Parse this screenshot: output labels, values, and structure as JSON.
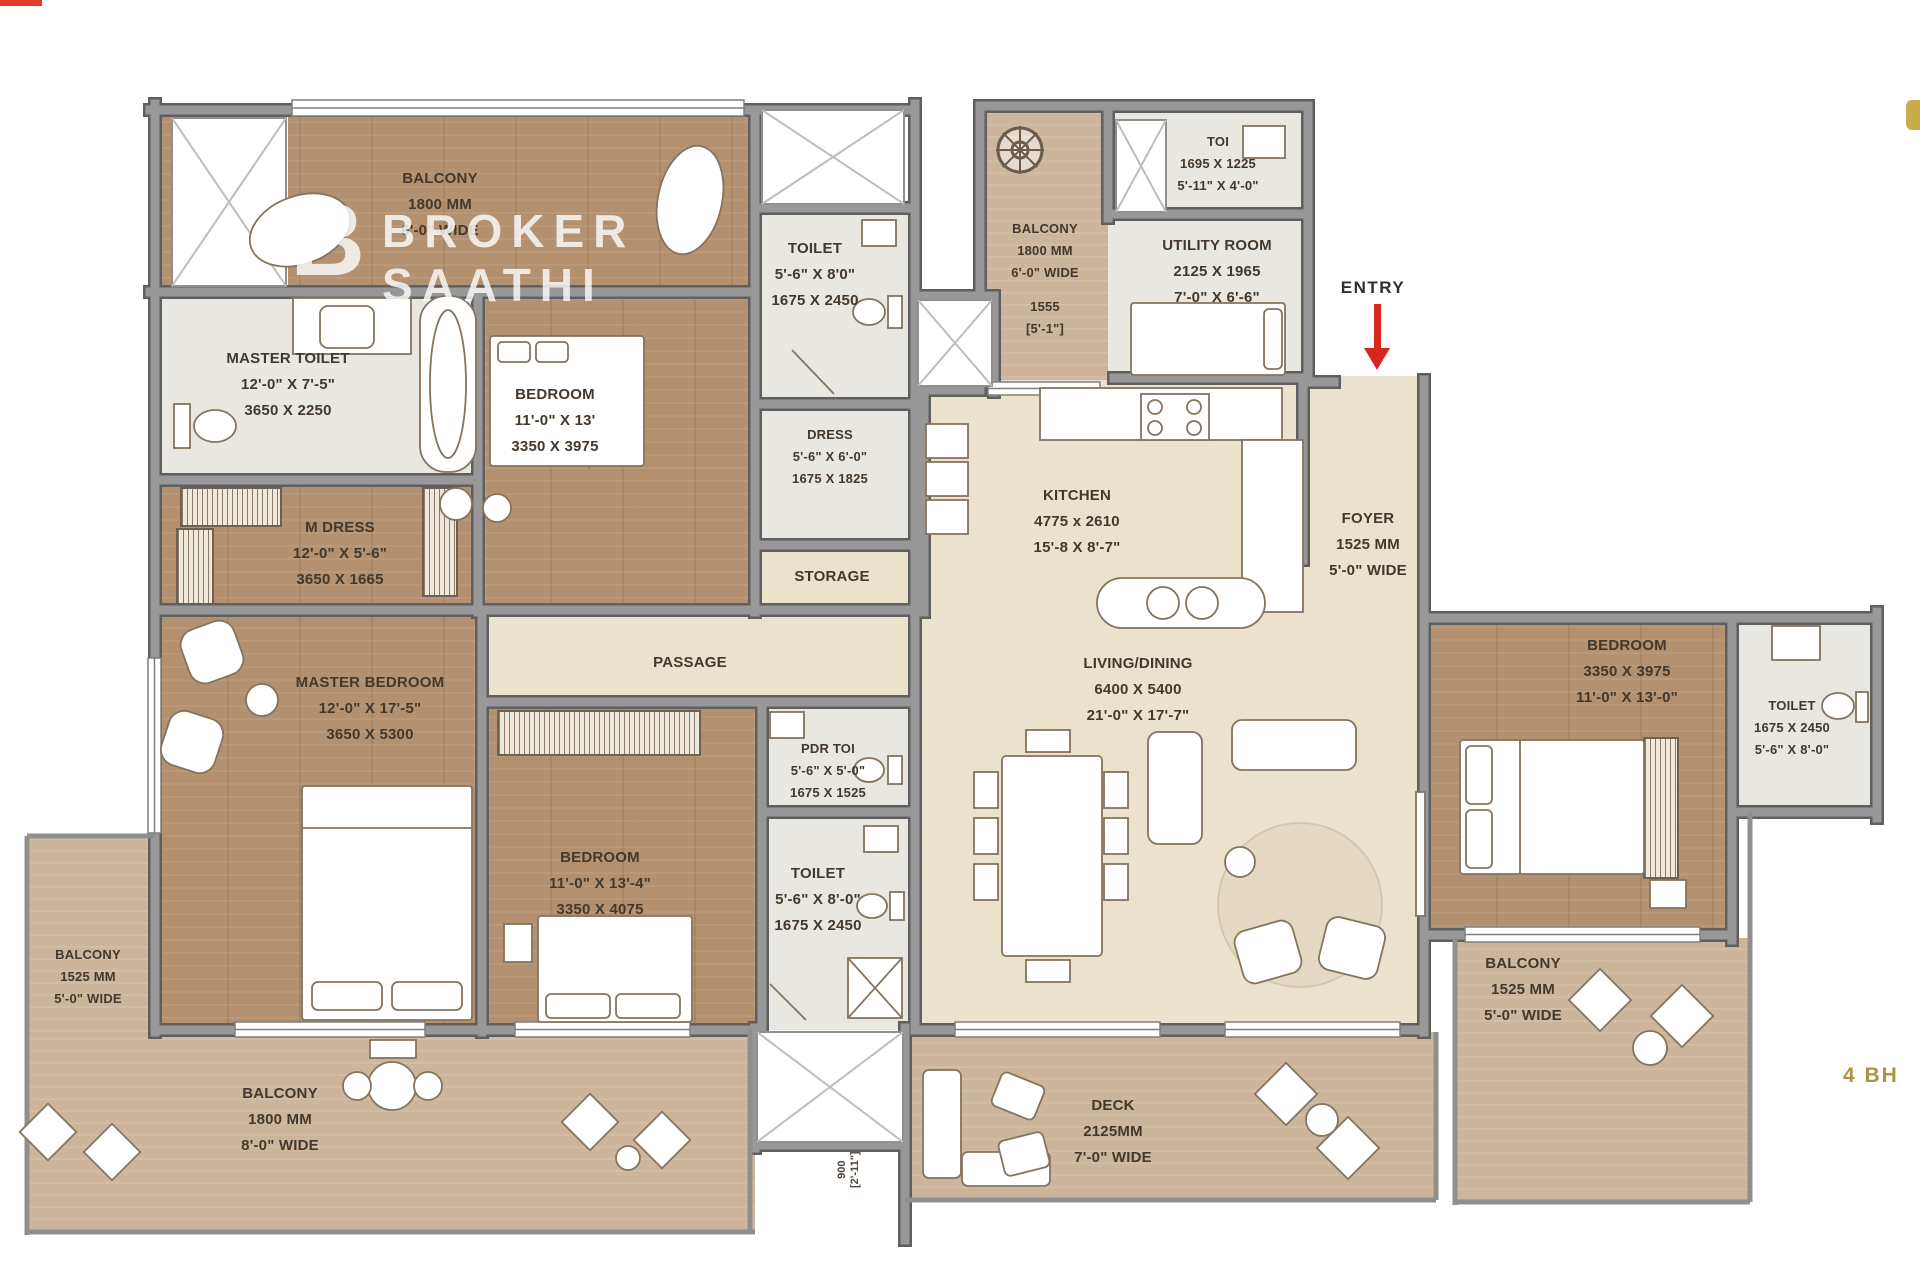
{
  "plan_type": "apartment-floor-plan",
  "watermark": {
    "logo": "B",
    "line1": "BROKER",
    "line2": "SAATHI"
  },
  "annotations": {
    "entry": "ENTRY",
    "bhk": "4 BH",
    "dim900_mm": "900",
    "dim900_ft": "[2'-11\"]"
  },
  "colors": {
    "wood_floor": "#b3906f",
    "balcony_floor": "#cdb59b",
    "living_floor": "#ebe2cd",
    "wall": "#949494",
    "entry_arrow": "#d8281e",
    "bhk_text": "#ab9440"
  },
  "rooms": {
    "balcony_tl": {
      "lines": [
        "BALCONY",
        "1800 MM",
        "6'-0\" WIDE"
      ]
    },
    "master_toilet": {
      "lines": [
        "MASTER TOILET",
        "12'-0\" X 7'-5\"",
        "3650 X 2250"
      ]
    },
    "bedroom_tl": {
      "lines": [
        "BEDROOM",
        "11'-0\" X 13'",
        "3350 X 3975"
      ]
    },
    "toilet_top": {
      "lines": [
        "TOILET",
        "5'-6\" X 8'0\"",
        "1675 X 2450"
      ]
    },
    "dress": {
      "lines": [
        "DRESS",
        "5'-6\" X 6'-0\"",
        "1675 X 1825"
      ]
    },
    "storage": {
      "lines": [
        "STORAGE"
      ]
    },
    "balcony_tm": {
      "lines": [
        "BALCONY",
        "1800 MM",
        "6'-0\" WIDE"
      ],
      "extra": [
        "1555",
        "[5'-1\"]"
      ]
    },
    "toi": {
      "lines": [
        "TOI",
        "1695 X 1225",
        "5'-11\" X 4'-0\""
      ]
    },
    "utility": {
      "lines": [
        "UTILITY ROOM",
        "2125 X 1965",
        "7'-0\" X 6'-6\""
      ]
    },
    "kitchen": {
      "lines": [
        "KITCHEN",
        "4775 x 2610",
        "15'-8 X 8'-7\""
      ]
    },
    "foyer": {
      "lines": [
        "FOYER",
        "1525 MM",
        "5'-0\" WIDE"
      ]
    },
    "m_dress": {
      "lines": [
        "M DRESS",
        "12'-0\" X 5'-6\"",
        "3650 X 1665"
      ]
    },
    "passage": {
      "lines": [
        "PASSAGE"
      ]
    },
    "master_bedroom": {
      "lines": [
        "MASTER BEDROOM",
        "12'-0\" X 17'-5\"",
        "3650 X 5300"
      ]
    },
    "bedroom_mid": {
      "lines": [
        "BEDROOM",
        "11'-0\" X 13'-4\"",
        "3350 X 4075"
      ]
    },
    "pdr_toi": {
      "lines": [
        "PDR TOI",
        "5'-6\" X 5'-0\"",
        "1675 X 1525"
      ]
    },
    "toilet_mid": {
      "lines": [
        "TOILET",
        "5'-6\" X 8'-0\"",
        "1675 X 2450"
      ]
    },
    "living": {
      "lines": [
        "LIVING/DINING",
        "6400 X 5400",
        "21'-0\" X 17'-7\""
      ]
    },
    "bedroom_r": {
      "lines": [
        "BEDROOM",
        "3350 X 3975",
        "11'-0\" X 13'-0\""
      ]
    },
    "toilet_r": {
      "lines": [
        "TOILET",
        "1675 X 2450",
        "5'-6\" X 8'-0\""
      ]
    },
    "balcony_l": {
      "lines": [
        "BALCONY",
        "1525 MM",
        "5'-0\" WIDE"
      ]
    },
    "balcony_b": {
      "lines": [
        "BALCONY",
        "1800 MM",
        "8'-0\" WIDE"
      ]
    },
    "deck": {
      "lines": [
        "DECK",
        "2125MM",
        "7'-0\" WIDE"
      ]
    },
    "balcony_r": {
      "lines": [
        "BALCONY",
        "1525 MM",
        "5'-0\" WIDE"
      ]
    }
  }
}
